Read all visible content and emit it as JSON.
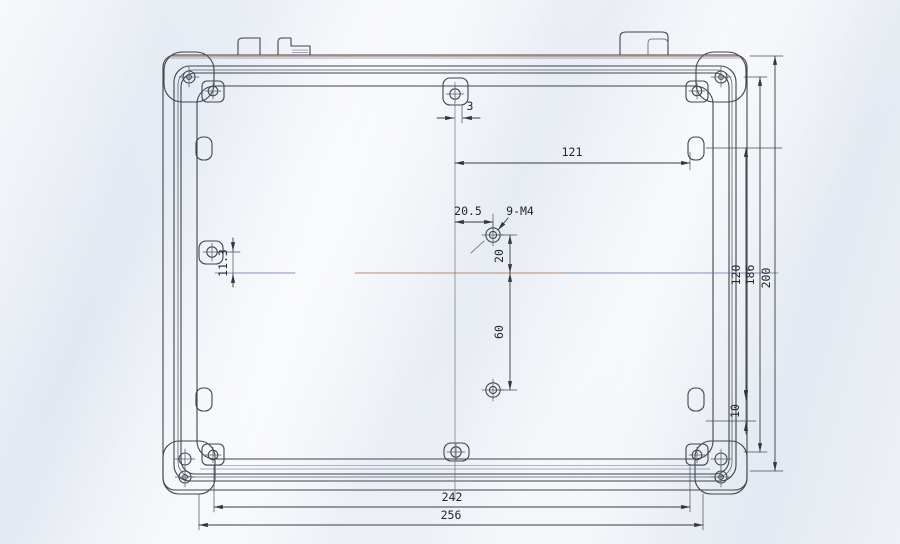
{
  "drawing": {
    "kind": "scanned-mechanical-drawing",
    "subject": "enclosure-lid-inside-view",
    "labels": {
      "dim_3": "3",
      "dim_121": "121",
      "dim_20_5": "20.5",
      "thread_callout": "9-M4",
      "dim_20": "20",
      "dim_60": "60",
      "dim_120": "120",
      "dim_186": "186",
      "dim_200": "200",
      "dim_11_3": "11.3",
      "dim_10": "10",
      "dim_242": "242",
      "dim_256": "256"
    },
    "colors": {
      "line": "#40444c",
      "dimension_line": "#383c44",
      "text": "#23272d",
      "scan_fringe_blue": "#5e71a6",
      "scan_fringe_red": "#9b6a52",
      "paper_light": "#f4f6fa",
      "paper_dark": "#e2e8f1"
    }
  }
}
